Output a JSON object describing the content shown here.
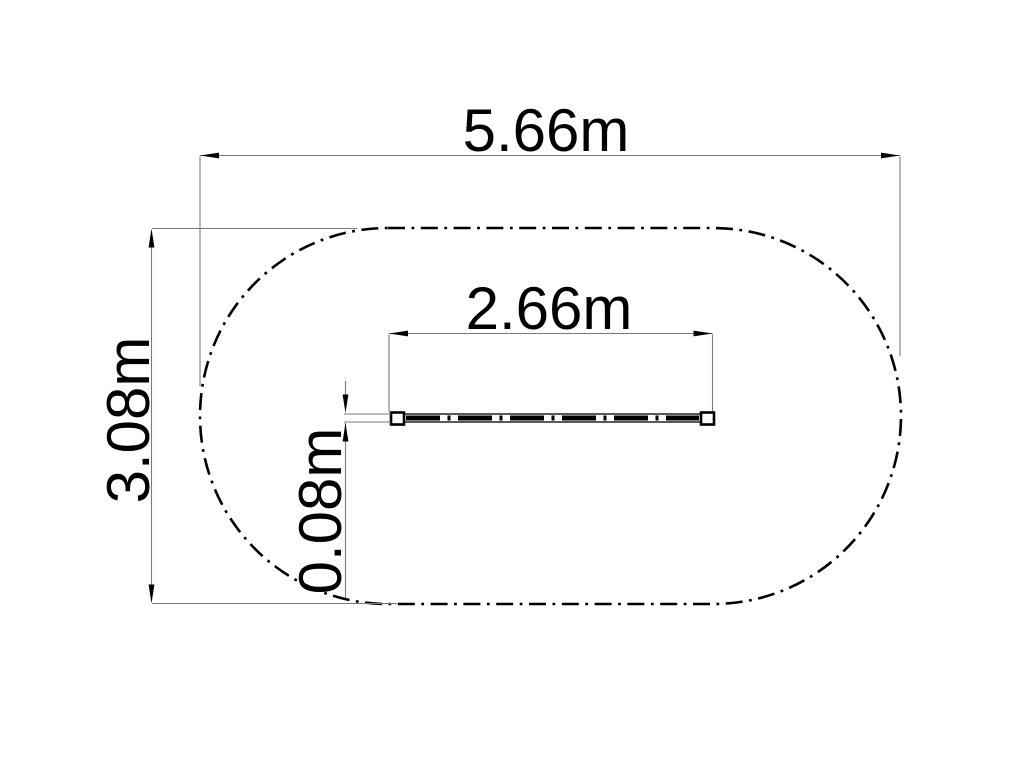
{
  "drawing": {
    "description": "Plan-view technical drawing of a balance beam inside an oval (stadium-shaped) dash-dot safety-zone outline, with linear dimensions",
    "labels": {
      "overall_width": "5.66m",
      "overall_height": "3.08m",
      "beam_length": "2.66m",
      "beam_width": "0.08m"
    },
    "values_m": {
      "overall_width": 5.66,
      "overall_height": 3.08,
      "beam_length": 2.66,
      "beam_width": 0.08
    },
    "colors": {
      "outline": "#000000",
      "dimension_line": "#7a7a7a",
      "text": "#000000",
      "background": "#ffffff"
    }
  }
}
